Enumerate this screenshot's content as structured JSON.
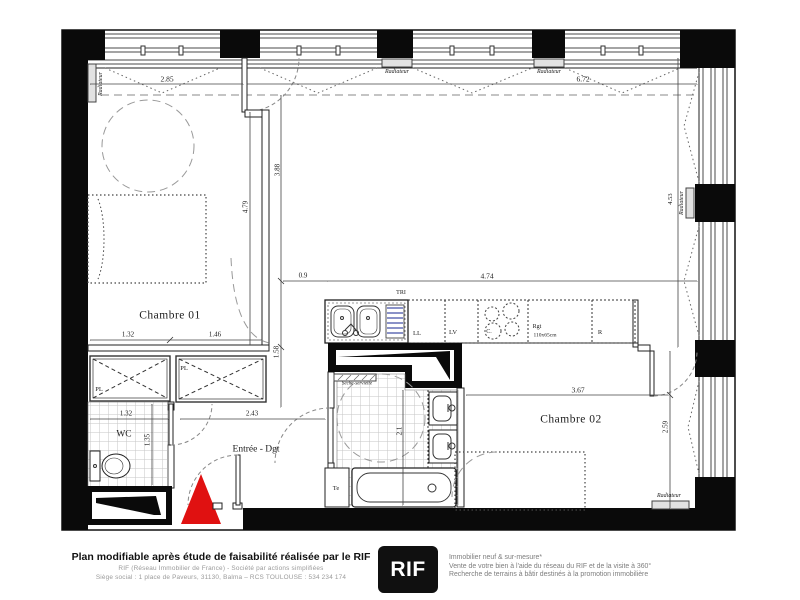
{
  "plan": {
    "rooms": {
      "chambre01": "Chambre 01",
      "chambre02": "Chambre 02",
      "wc": "WC",
      "entree": "Entrée - Dgt"
    },
    "equipment": {
      "radiateur": "Radiateur",
      "tri": "TRI",
      "lave_linge": "LL",
      "lave_vaisselle": "LV",
      "cuisson": "C.",
      "rangement": "Rgt",
      "rangement_size": "110x65cm",
      "refrigerateur": "R",
      "tablette": "Te",
      "seche_serviette": "Sèche-serviette",
      "placard_gauche": "PL",
      "placard_droit": "PL"
    },
    "dims": {
      "w285": "2.85",
      "w672": "6.72",
      "h479": "4.79",
      "h388": "3.88",
      "h158": "1.58",
      "w09": "0.9",
      "w474": "4.74",
      "w132": "1.32",
      "w146": "1.46",
      "wc132": "1.32",
      "wc135": "1.35",
      "w243": "2.43",
      "h21": "2.1",
      "w367": "3.67",
      "h259": "2.59",
      "h453": "4.53"
    }
  },
  "footer": {
    "left_title": "Plan modifiable après étude de faisabilité réalisée par le RIF",
    "left_line1": "RIF (Réseau Immobilier de France)  -  Société par actions simplifiées",
    "left_line2": "Siège social : 1 place de Paveurs, 31130, Balma – RCS TOULOUSE : 534 234 174",
    "logo_text": "RIF",
    "right_line1": "Immobilier neuf & sur-mesure*",
    "right_line2": "Vente de votre bien à l'aide du réseau du RIF et de la visite à 360°",
    "right_line3": "Recherche de terrains à bâtir destinés à la promotion immobilière"
  },
  "colors": {
    "entrance_arrow": "#e01111",
    "drainboard": "#8a92c8",
    "wall": "#0a0a0a"
  }
}
